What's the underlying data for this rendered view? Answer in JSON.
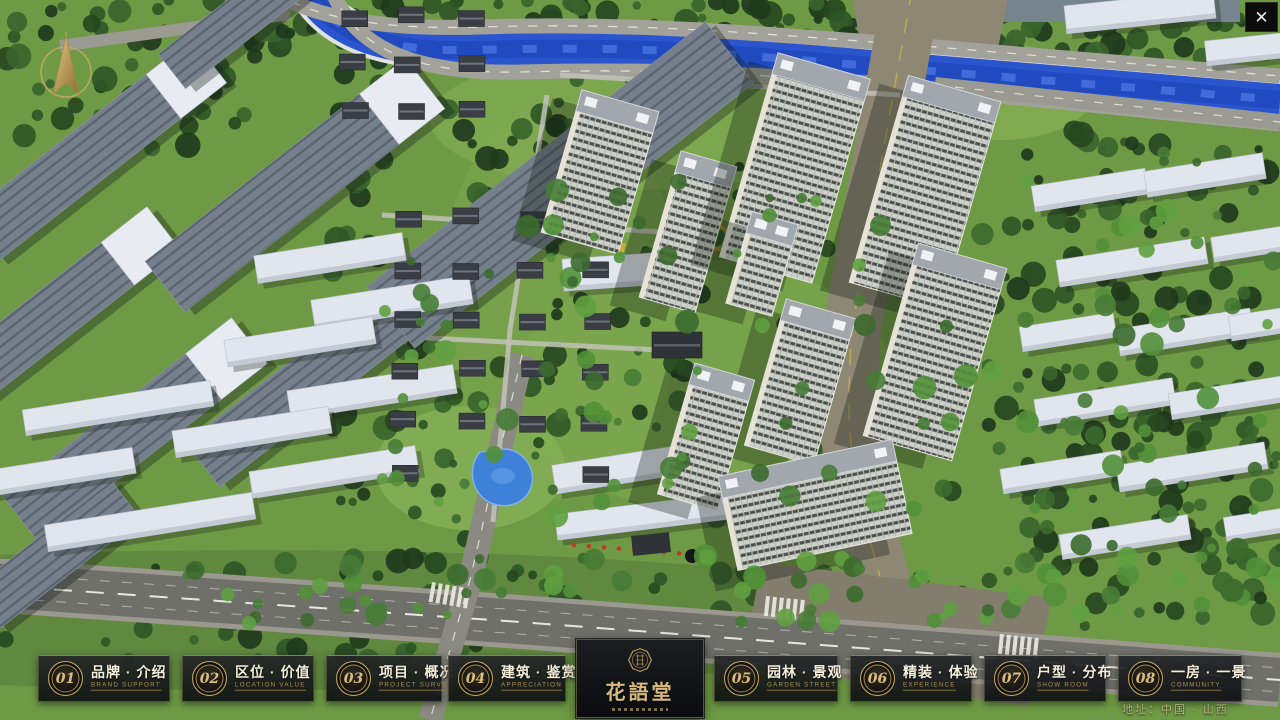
{
  "window": {
    "close_button": "✕"
  },
  "icons": {
    "compass": "north-compass-arrow",
    "close": "close-x",
    "logo_emblem": "round-seal-emblem"
  },
  "nav": {
    "items": [
      {
        "num": "01",
        "zh": "品牌 · 介绍",
        "en": "BRAND SUPPORT"
      },
      {
        "num": "02",
        "zh": "区位 · 价值",
        "en": "LOCATION VALUE"
      },
      {
        "num": "03",
        "zh": "项目 · 概况",
        "en": "PROJECT SURVEY"
      },
      {
        "num": "04",
        "zh": "建筑 · 鉴赏",
        "en": "APPRECIATION"
      },
      {
        "num": "05",
        "zh": "园林 · 景观",
        "en": "GARDEN STREET"
      },
      {
        "num": "06",
        "zh": "精装 · 体验",
        "en": "EXPERIENCE"
      },
      {
        "num": "07",
        "zh": "户型 · 分布",
        "en": "SHOW ROOM"
      },
      {
        "num": "08",
        "zh": "一房 · 一景",
        "en": "COMMUNITY"
      }
    ]
  },
  "logo": {
    "title": "花語堂"
  },
  "footer": {
    "address": "地址：中国 · 山西"
  },
  "colors": {
    "gold": "#c9a961",
    "cream": "#f3edda",
    "panel_bg": "#121416",
    "river": "#2b55cf",
    "grass": "#7ca350"
  }
}
